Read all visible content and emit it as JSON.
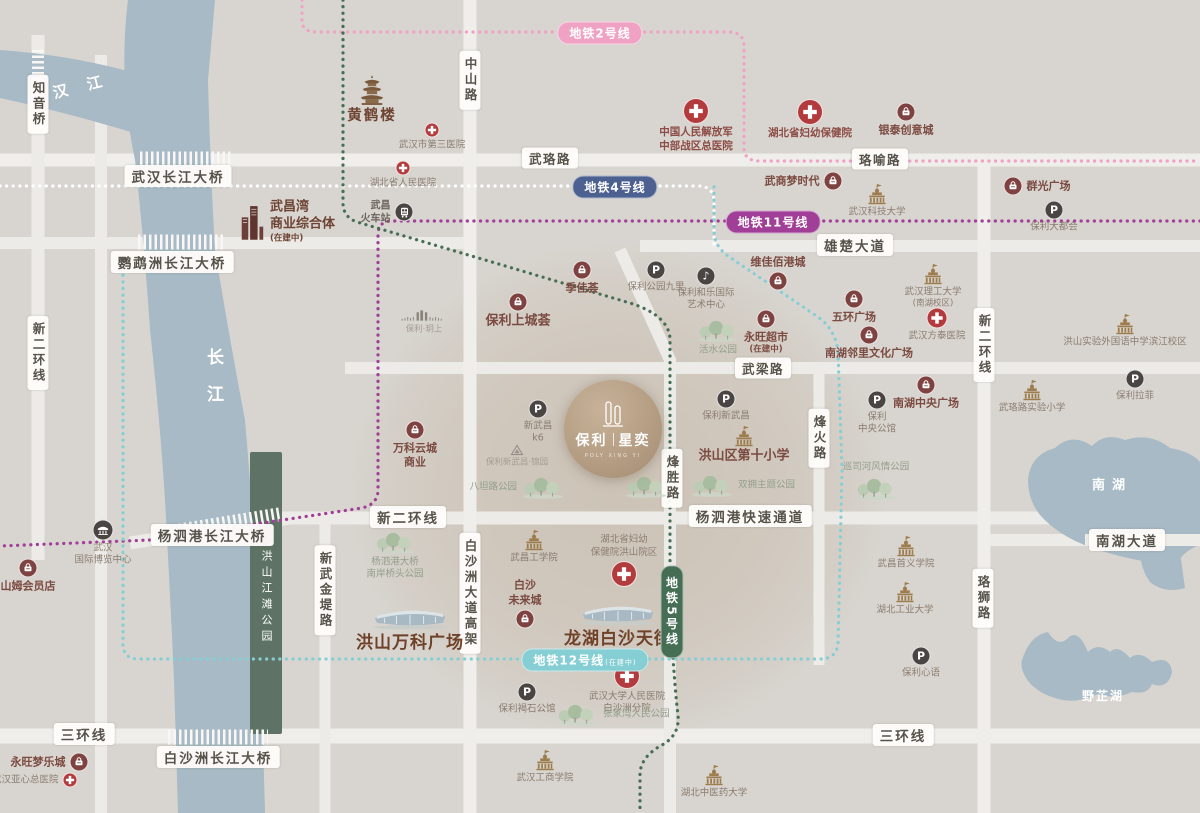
{
  "project": {
    "name_part1": "保利",
    "name_part2": "星奕",
    "caption": "POLY XING YI"
  },
  "water": {
    "hanjiang": "汉江",
    "changjiang": "长江",
    "nanhu": "南湖",
    "yezhihu": "野芷湖",
    "park_strip": "洪山江滩公园"
  },
  "colors": {
    "background": "#d8d5d0",
    "road": "#ecebe7",
    "water": "#a7bac5",
    "park_strip": "#5e7365",
    "brand_maroon": "#7b4a40",
    "icon_maroon": "#7e4241",
    "icon_dark": "#4a4442",
    "hospital_red": "#b23b3d",
    "school_tan": "#9d7c4e"
  },
  "metro_lines": [
    {
      "id": "line2",
      "label": "地铁2号线",
      "color": "#f0a2c4",
      "pill": {
        "x": 600,
        "y": 33
      }
    },
    {
      "id": "line4",
      "label": "地铁4号线",
      "color": "#4d6191",
      "dot_color": "#ffffff",
      "pill": {
        "x": 615,
        "y": 187
      }
    },
    {
      "id": "line11",
      "label": "地铁11号线",
      "color": "#a13e97",
      "pill": {
        "x": 773,
        "y": 222
      }
    },
    {
      "id": "line12",
      "label": "地铁12号线",
      "suffix": "(在建中)",
      "color": "#85ced4",
      "pill": {
        "x": 585,
        "y": 660
      }
    },
    {
      "id": "line5",
      "label": "地铁5号线",
      "color": "#456e54",
      "pill": {
        "x": 672,
        "y": 612
      },
      "vertical": true
    }
  ],
  "road_labels": [
    {
      "text": "知音桥",
      "x": 38,
      "y": 104,
      "v": true
    },
    {
      "text": "中山路",
      "x": 470,
      "y": 80,
      "v": true
    },
    {
      "text": "武珞路",
      "x": 550,
      "y": 158
    },
    {
      "text": "珞喻路",
      "x": 880,
      "y": 159
    },
    {
      "text": "雄楚大道",
      "x": 855,
      "y": 245,
      "big": true
    },
    {
      "text": "武梁路",
      "x": 763,
      "y": 368
    },
    {
      "text": "新二环线",
      "x": 38,
      "y": 353,
      "v": true
    },
    {
      "text": "新二环线",
      "x": 984,
      "y": 345,
      "v": true
    },
    {
      "text": "烽胜路",
      "x": 672,
      "y": 478,
      "v": true
    },
    {
      "text": "烽火路",
      "x": 819,
      "y": 438,
      "v": true
    },
    {
      "text": "新二环线",
      "x": 408,
      "y": 517,
      "big": true
    },
    {
      "text": "杨泗港快速通道",
      "x": 750,
      "y": 516,
      "big": true
    },
    {
      "text": "南湖大道",
      "x": 1127,
      "y": 540,
      "big": true
    },
    {
      "text": "白沙洲大道高架",
      "x": 470,
      "y": 593,
      "v": true
    },
    {
      "text": "新武金堤路",
      "x": 325,
      "y": 590,
      "v": true
    },
    {
      "text": "珞狮路",
      "x": 983,
      "y": 598,
      "v": true
    },
    {
      "text": "三环线",
      "x": 84,
      "y": 734,
      "big": true
    },
    {
      "text": "三环线",
      "x": 903,
      "y": 735,
      "big": true
    },
    {
      "text": "武汉长江大桥",
      "x": 178,
      "y": 176,
      "big": true
    },
    {
      "text": "鹦鹉洲长江大桥",
      "x": 172,
      "y": 262,
      "big": true
    },
    {
      "text": "杨泗港长江大桥",
      "x": 212,
      "y": 535,
      "big": true
    },
    {
      "text": "白沙洲长江大桥",
      "x": 218,
      "y": 757,
      "big": true
    }
  ],
  "pois": [
    {
      "t": "pagoda",
      "x": 372,
      "y": 90,
      "lines": [
        "黄鹤楼"
      ],
      "cls": "lg2"
    },
    {
      "t": "cross-s",
      "x": 432,
      "y": 130,
      "lines": [
        "武汉市第三医院"
      ]
    },
    {
      "t": "cross-l",
      "x": 696,
      "y": 111,
      "lines": [
        "中国人民解放军",
        "中部战区总医院"
      ],
      "cls": "hos"
    },
    {
      "t": "cross-l",
      "x": 810,
      "y": 112,
      "lines": [
        "湖北省妇幼保健院"
      ],
      "cls": "hos"
    },
    {
      "t": "bag",
      "x": 906,
      "y": 112,
      "lines": [
        "银泰创意城"
      ],
      "cls": "md"
    },
    {
      "t": "cross-s",
      "x": 403,
      "y": 168,
      "lines": [
        "湖北省人民医院"
      ]
    },
    {
      "t": "train",
      "x": 404,
      "y": 212,
      "lines": [
        "武昌",
        "火车站"
      ],
      "lp": "l",
      "cls": "stn"
    },
    {
      "t": "bag",
      "x": 833,
      "y": 181,
      "lines": [
        "武商梦时代"
      ],
      "lp": "l",
      "cls": "md"
    },
    {
      "t": "bag",
      "x": 1013,
      "y": 186,
      "lines": [
        "群光广场"
      ],
      "lp": "r",
      "cls": "md"
    },
    {
      "t": "school",
      "x": 877,
      "y": 194,
      "lines": [
        "武汉科技大学"
      ]
    },
    {
      "t": "p",
      "x": 1054,
      "y": 210,
      "lines": [
        "保利大都会"
      ]
    },
    {
      "t": "towers",
      "x": 252,
      "y": 222,
      "lines": [
        "武昌湾",
        "商业综合体",
        "(在建中)"
      ],
      "lp": "r",
      "cls": "md3"
    },
    {
      "t": "bag",
      "x": 778,
      "y": 281,
      "lines": [
        "维佳佰港城"
      ],
      "lp": "t",
      "cls": "md"
    },
    {
      "t": "school",
      "x": 933,
      "y": 274,
      "lines": [
        "武汉理工大学",
        "(南湖校区)"
      ]
    },
    {
      "t": "bag",
      "x": 582,
      "y": 270,
      "lines": [
        "季佳荟"
      ],
      "cls": "md"
    },
    {
      "t": "p",
      "x": 656,
      "y": 270,
      "lines": [
        "保利公园九里"
      ]
    },
    {
      "t": "music",
      "x": 706,
      "y": 276,
      "lines": [
        "保利和乐国际",
        "艺术中心"
      ]
    },
    {
      "t": "bag",
      "x": 518,
      "y": 302,
      "lines": [
        "保利上城荟"
      ],
      "cls": "md2"
    },
    {
      "t": "bag",
      "x": 766,
      "y": 319,
      "lines": [
        "永旺超市",
        "(在建中)"
      ],
      "cls": "md"
    },
    {
      "t": "bag",
      "x": 854,
      "y": 299,
      "lines": [
        "五环广场"
      ],
      "cls": "md"
    },
    {
      "t": "cross-m",
      "x": 937,
      "y": 318,
      "lines": [
        "武汉方泰医院"
      ]
    },
    {
      "t": "bag",
      "x": 869,
      "y": 335,
      "lines": [
        "南湖邻里文化广场"
      ],
      "cls": "md"
    },
    {
      "t": "trees",
      "x": 718,
      "y": 330,
      "lines": [
        "活水公园"
      ],
      "cls": "pk"
    },
    {
      "t": "school",
      "x": 1125,
      "y": 324,
      "lines": [
        "洪山实验外国语中学滨江校区"
      ]
    },
    {
      "t": "p",
      "x": 1135,
      "y": 379,
      "lines": [
        "保利拉菲"
      ]
    },
    {
      "t": "school",
      "x": 1032,
      "y": 390,
      "lines": [
        "武珞路实验小学"
      ]
    },
    {
      "t": "bag",
      "x": 926,
      "y": 385,
      "lines": [
        "南湖中央广场"
      ],
      "cls": "md"
    },
    {
      "t": "p",
      "x": 877,
      "y": 400,
      "lines": [
        "保利",
        "中央公馆"
      ]
    },
    {
      "t": "bars",
      "x": 424,
      "y": 316,
      "lines": [
        "保利·玥上"
      ],
      "cls": "xs"
    },
    {
      "t": "bag",
      "x": 415,
      "y": 430,
      "lines": [
        "万科云城",
        "商业"
      ],
      "cls": "md"
    },
    {
      "t": "p",
      "x": 538,
      "y": 409,
      "lines": [
        "新武昌",
        "k6"
      ]
    },
    {
      "t": "p",
      "x": 726,
      "y": 399,
      "lines": [
        "保利新武昌"
      ]
    },
    {
      "t": "school",
      "x": 744,
      "y": 436,
      "lines": [
        "洪山区第十小学"
      ],
      "cls": "md2"
    },
    {
      "t": "triangle",
      "x": 517,
      "y": 450,
      "lines": [
        "保利新武昌·锦园"
      ],
      "cls": "xs"
    },
    {
      "t": "trees",
      "x": 543,
      "y": 487,
      "lines": [
        "八坦路公园"
      ],
      "lp": "l",
      "cls": "pk"
    },
    {
      "t": "trees",
      "x": 646,
      "y": 486,
      "lines": [],
      "cls": "pk"
    },
    {
      "t": "trees",
      "x": 712,
      "y": 485,
      "lines": [
        "双拥主题公园"
      ],
      "lp": "r",
      "cls": "pk"
    },
    {
      "t": "trees",
      "x": 876,
      "y": 488,
      "lines": [
        "巡司河风情公园"
      ],
      "lp": "t",
      "cls": "pk"
    },
    {
      "t": "expo",
      "x": 103,
      "y": 530,
      "lines": [
        "武汉",
        "国际博览中心"
      ]
    },
    {
      "t": "bag",
      "x": 28,
      "y": 568,
      "lines": [
        "山姆会员店"
      ],
      "cls": "md"
    },
    {
      "t": "trees",
      "x": 395,
      "y": 542,
      "lines": [
        "杨泗港大桥",
        "南岸桥头公园"
      ],
      "cls": "pk"
    },
    {
      "t": "school",
      "x": 534,
      "y": 540,
      "lines": [
        "武昌工学院"
      ]
    },
    {
      "t": "cross-l",
      "x": 624,
      "y": 574,
      "lines": [
        "湖北省妇幼",
        "保健院洪山院区"
      ],
      "lp": "t"
    },
    {
      "t": "bag",
      "x": 525,
      "y": 619,
      "lines": [
        "白沙",
        "未来城"
      ],
      "lp": "t",
      "cls": "md"
    },
    {
      "t": "mall",
      "x": 410,
      "y": 617,
      "lines": [
        "洪山万科广场"
      ],
      "cls": "lg"
    },
    {
      "t": "mall",
      "x": 618,
      "y": 613,
      "lines": [
        "龙湖白沙天街"
      ],
      "cls": "lg"
    },
    {
      "t": "cross-l",
      "x": 627,
      "y": 676,
      "lines": [
        "武汉大学人民医院",
        "白沙洲分院"
      ]
    },
    {
      "t": "p",
      "x": 527,
      "y": 692,
      "lines": [
        "保利褐石公馆"
      ]
    },
    {
      "t": "trees",
      "x": 577,
      "y": 714,
      "lines": [
        "张家湾人民公园"
      ],
      "lp": "r",
      "cls": "pk"
    },
    {
      "t": "school",
      "x": 545,
      "y": 760,
      "lines": [
        "武汉工商学院"
      ]
    },
    {
      "t": "school",
      "x": 714,
      "y": 775,
      "lines": [
        "湖北中医药大学"
      ]
    },
    {
      "t": "school",
      "x": 906,
      "y": 546,
      "lines": [
        "武昌首义学院"
      ]
    },
    {
      "t": "school",
      "x": 905,
      "y": 592,
      "lines": [
        "湖北工业大学"
      ]
    },
    {
      "t": "p",
      "x": 921,
      "y": 656,
      "lines": [
        "保利心语"
      ]
    },
    {
      "t": "bag",
      "x": 79,
      "y": 762,
      "lines": [
        "永旺梦乐城"
      ],
      "lp": "l",
      "cls": "md"
    },
    {
      "t": "cross-s",
      "x": 70,
      "y": 780,
      "lines": [
        "武汉亚心总医院"
      ],
      "lp": "l"
    }
  ]
}
